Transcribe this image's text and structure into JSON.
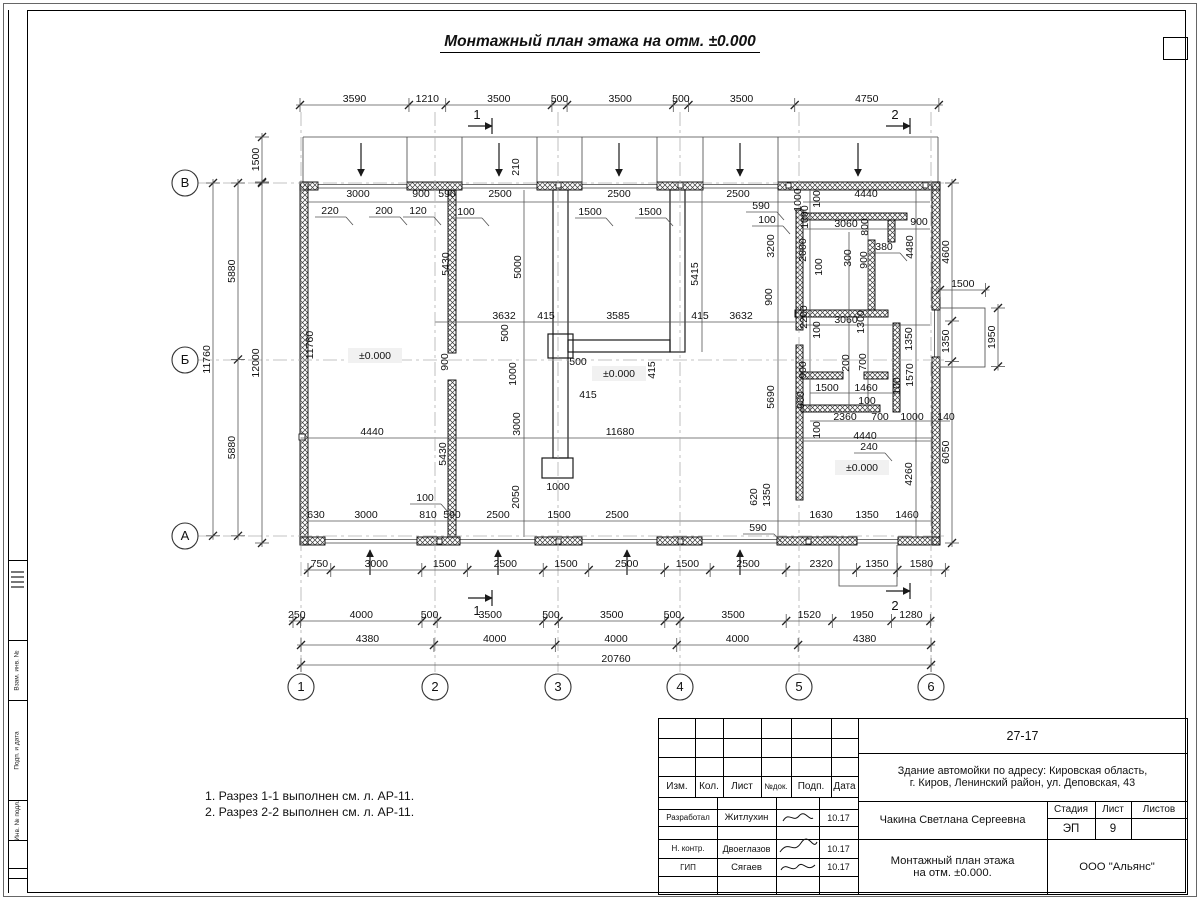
{
  "sheet": {
    "title": "Монтажный план этажа на отм. ±0.000",
    "notes": [
      "1. Разрез 1-1 выполнен см. л. АР-11.",
      "2. Разрез 2-2 выполнен см. л. АР-11."
    ]
  },
  "axes": {
    "rows": [
      "В",
      "Б",
      "А"
    ],
    "cols": [
      "1",
      "2",
      "3",
      "4",
      "5",
      "6"
    ]
  },
  "elevation_mark": "±0.000",
  "title_block": {
    "code": "27-17",
    "address_line1": "Здание автомойки по адресу: Кировская область,",
    "address_line2": "г. Киров, Ленинский район, ул. Деповская, 43",
    "rev_headers": [
      "Изм.",
      "Кол.",
      "Лист",
      "№док.",
      "Подп.",
      "Дата"
    ],
    "people": [
      {
        "role": "Разработал",
        "name": "Житлухин",
        "date": "10.17"
      },
      {
        "role": "Н. контр.",
        "name": "Двоеглазов",
        "date": "10.17"
      },
      {
        "role": "ГИП",
        "name": "Сягаев",
        "date": "10.17"
      }
    ],
    "author": "Чакина Светлана Сергеевна",
    "stage_label": "Стадия",
    "sheet_label": "Лист",
    "sheets_label": "Листов",
    "stage": "ЭП",
    "sheet_no": "9",
    "sheets_total": "",
    "drawing_title_line1": "Монтажный план этажа",
    "drawing_title_line2": "на отм. ±0.000.",
    "org": "ООО \"Альянс\""
  },
  "left_stamp": [
    "Взам. инв. №",
    "Подп. и дата",
    "Инв. № подл."
  ],
  "chains": [
    {
      "o": "h",
      "x": 300,
      "y": 105,
      "mm": [
        3590,
        1210,
        3500,
        500,
        3500,
        500,
        3500,
        4750
      ]
    },
    {
      "o": "h",
      "x": 308,
      "y": 570,
      "mm": [
        750,
        3000,
        1500,
        2500,
        1500,
        2500,
        1500,
        2500,
        2320,
        1350,
        1580
      ]
    },
    {
      "o": "h",
      "x": 293,
      "y": 621,
      "mm": [
        250,
        4000,
        500,
        3500,
        500,
        3500,
        500,
        3500,
        1520,
        1950,
        1280
      ]
    },
    {
      "o": "h",
      "x": 301,
      "y": 645,
      "mm": [
        4380,
        4000,
        4000,
        4000,
        4380
      ]
    },
    {
      "o": "h",
      "x": 301,
      "y": 665,
      "mm": [
        20760
      ]
    },
    {
      "o": "v",
      "x": 213,
      "y": 183,
      "mm": [
        11760
      ]
    },
    {
      "o": "v",
      "x": 238,
      "y": 183,
      "mm": [
        5880,
        5880
      ]
    },
    {
      "o": "v",
      "x": 262,
      "y": 183,
      "mm": [
        12000
      ]
    },
    {
      "o": "v",
      "x": 262,
      "y": 137,
      "mm": [
        1500
      ]
    },
    {
      "o": "v",
      "x": 952,
      "y": 183,
      "mm": [
        4600,
        1350,
        6050
      ]
    },
    {
      "o": "v",
      "x": 998,
      "y": 308,
      "mm": [
        1950
      ]
    },
    {
      "o": "h",
      "x": 940,
      "y": 290,
      "mm": [
        1500
      ]
    }
  ],
  "labels": [
    {
      "t": "3000",
      "x": 358,
      "y": 197
    },
    {
      "t": "900",
      "x": 421,
      "y": 197
    },
    {
      "t": "590",
      "x": 447,
      "y": 197
    },
    {
      "t": "2500",
      "x": 500,
      "y": 197
    },
    {
      "t": "2500",
      "x": 619,
      "y": 197
    },
    {
      "t": "2500",
      "x": 738,
      "y": 197
    },
    {
      "t": "4440",
      "x": 866,
      "y": 197
    },
    {
      "t": "220",
      "x": 330,
      "y": 214,
      "u": 1
    },
    {
      "t": "200",
      "x": 384,
      "y": 214,
      "u": 1
    },
    {
      "t": "120",
      "x": 418,
      "y": 214,
      "u": 1
    },
    {
      "t": "100",
      "x": 466,
      "y": 215,
      "u": 1
    },
    {
      "t": "1500",
      "x": 590,
      "y": 215,
      "u": 1
    },
    {
      "t": "1500",
      "x": 650,
      "y": 215,
      "u": 1
    },
    {
      "t": "590",
      "x": 761,
      "y": 209,
      "u": 1
    },
    {
      "t": "100",
      "x": 767,
      "y": 223,
      "u": 1
    },
    {
      "t": "210",
      "x": 519,
      "y": 167,
      "r": 1
    },
    {
      "t": "1000",
      "x": 801,
      "y": 200,
      "r": 1
    },
    {
      "t": "100",
      "x": 820,
      "y": 199,
      "r": 1
    },
    {
      "t": "1000",
      "x": 808,
      "y": 217,
      "r": 1
    },
    {
      "t": "3200",
      "x": 774,
      "y": 246,
      "r": 1
    },
    {
      "t": "2000",
      "x": 806,
      "y": 250,
      "r": 1
    },
    {
      "t": "3060",
      "x": 846,
      "y": 227
    },
    {
      "t": "800",
      "x": 868,
      "y": 227,
      "r": 1
    },
    {
      "t": "900",
      "x": 919,
      "y": 225
    },
    {
      "t": "380",
      "x": 884,
      "y": 250,
      "u": 1
    },
    {
      "t": "4480",
      "x": 913,
      "y": 247,
      "r": 1
    },
    {
      "t": "300",
      "x": 851,
      "y": 258,
      "r": 1
    },
    {
      "t": "900",
      "x": 867,
      "y": 260,
      "r": 1
    },
    {
      "t": "100",
      "x": 822,
      "y": 267,
      "r": 1
    },
    {
      "t": "900",
      "x": 772,
      "y": 297,
      "r": 1
    },
    {
      "t": "2200",
      "x": 807,
      "y": 317,
      "r": 1
    },
    {
      "t": "3060",
      "x": 846,
      "y": 323
    },
    {
      "t": "1300",
      "x": 864,
      "y": 322,
      "r": 1
    },
    {
      "t": "100",
      "x": 820,
      "y": 330,
      "r": 1
    },
    {
      "t": "1350",
      "x": 912,
      "y": 339,
      "r": 1
    },
    {
      "t": "5000",
      "x": 521,
      "y": 267,
      "r": 1
    },
    {
      "t": "5430",
      "x": 449,
      "y": 264,
      "r": 1
    },
    {
      "t": "5415",
      "x": 698,
      "y": 274,
      "r": 1
    },
    {
      "t": "3632",
      "x": 504,
      "y": 319
    },
    {
      "t": "415",
      "x": 546,
      "y": 319
    },
    {
      "t": "3585",
      "x": 618,
      "y": 319
    },
    {
      "t": "415",
      "x": 700,
      "y": 319
    },
    {
      "t": "3632",
      "x": 741,
      "y": 319
    },
    {
      "t": "500",
      "x": 508,
      "y": 333,
      "r": 1
    },
    {
      "t": "1000",
      "x": 516,
      "y": 374,
      "r": 1
    },
    {
      "t": "500",
      "x": 578,
      "y": 365
    },
    {
      "t": "415",
      "x": 655,
      "y": 370,
      "r": 1
    },
    {
      "t": "900",
      "x": 448,
      "y": 362,
      "r": 1
    },
    {
      "t": "11760",
      "x": 313,
      "y": 345,
      "r": 1
    },
    {
      "t": "±0.000",
      "x": 375,
      "y": 359,
      "b": 1
    },
    {
      "t": "±0.000",
      "x": 619,
      "y": 377,
      "b": 1
    },
    {
      "t": "±0.000",
      "x": 862,
      "y": 471,
      "b": 1
    },
    {
      "t": "200",
      "x": 849,
      "y": 363,
      "r": 1
    },
    {
      "t": "700",
      "x": 866,
      "y": 362,
      "r": 1
    },
    {
      "t": "900",
      "x": 806,
      "y": 370,
      "r": 1
    },
    {
      "t": "5690",
      "x": 774,
      "y": 397,
      "r": 1
    },
    {
      "t": "1570",
      "x": 913,
      "y": 375,
      "r": 1
    },
    {
      "t": "100",
      "x": 900,
      "y": 386,
      "r": 1
    },
    {
      "t": "1500",
      "x": 827,
      "y": 391
    },
    {
      "t": "1460",
      "x": 866,
      "y": 391
    },
    {
      "t": "100",
      "x": 867,
      "y": 404
    },
    {
      "t": "900",
      "x": 804,
      "y": 400,
      "r": 1
    },
    {
      "t": "2360",
      "x": 845,
      "y": 420
    },
    {
      "t": "700",
      "x": 880,
      "y": 420
    },
    {
      "t": "1000",
      "x": 912,
      "y": 420
    },
    {
      "t": "140",
      "x": 946,
      "y": 420
    },
    {
      "t": "100",
      "x": 820,
      "y": 430,
      "r": 1
    },
    {
      "t": "4440",
      "x": 865,
      "y": 439
    },
    {
      "t": "240",
      "x": 869,
      "y": 450,
      "u": 1
    },
    {
      "t": "4260",
      "x": 912,
      "y": 474,
      "r": 1
    },
    {
      "t": "620",
      "x": 757,
      "y": 497,
      "r": 1
    },
    {
      "t": "1350",
      "x": 770,
      "y": 495,
      "r": 1
    },
    {
      "t": "4440",
      "x": 372,
      "y": 435
    },
    {
      "t": "11680",
      "x": 620,
      "y": 435
    },
    {
      "t": "5430",
      "x": 446,
      "y": 454,
      "r": 1
    },
    {
      "t": "3000",
      "x": 520,
      "y": 424,
      "r": 1
    },
    {
      "t": "2050",
      "x": 519,
      "y": 497,
      "r": 1
    },
    {
      "t": "415",
      "x": 588,
      "y": 398
    },
    {
      "t": "1000",
      "x": 558,
      "y": 490
    },
    {
      "t": "100",
      "x": 425,
      "y": 501,
      "u": 1
    },
    {
      "t": "630",
      "x": 316,
      "y": 518
    },
    {
      "t": "3000",
      "x": 366,
      "y": 518
    },
    {
      "t": "810",
      "x": 428,
      "y": 518
    },
    {
      "t": "590",
      "x": 452,
      "y": 518
    },
    {
      "t": "2500",
      "x": 498,
      "y": 518
    },
    {
      "t": "1500",
      "x": 559,
      "y": 518
    },
    {
      "t": "2500",
      "x": 617,
      "y": 518
    },
    {
      "t": "590",
      "x": 758,
      "y": 531,
      "u": 1
    },
    {
      "t": "1630",
      "x": 821,
      "y": 518
    },
    {
      "t": "1350",
      "x": 867,
      "y": 518
    },
    {
      "t": "1460",
      "x": 907,
      "y": 518
    },
    {
      "t": "1",
      "x": 477,
      "y": 119,
      "s": 1
    },
    {
      "t": "2",
      "x": 895,
      "y": 119,
      "s": 1
    },
    {
      "t": "1",
      "x": 477,
      "y": 615,
      "s": 1
    },
    {
      "t": "2",
      "x": 895,
      "y": 610,
      "s": 1
    }
  ]
}
